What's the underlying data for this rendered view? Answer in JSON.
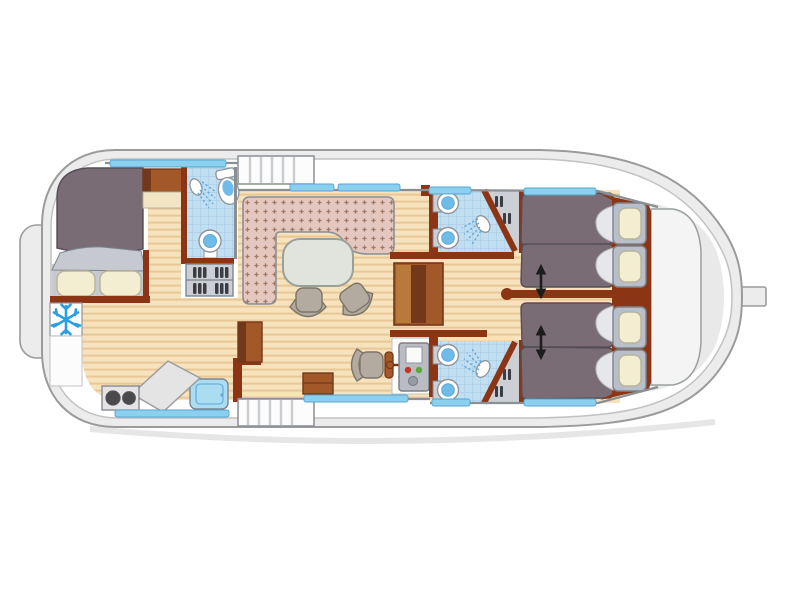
{
  "meta": {
    "title": "Houseboat deck floor plan (top view)",
    "canvas": {
      "width": 800,
      "height": 600
    }
  },
  "palette": {
    "bg": "#ffffff",
    "shadow": "#dedede",
    "hull_fill": "#ececec",
    "hull_stroke": "#9b9b9b",
    "deck_fill": "#ffffff",
    "deck_stroke": "#c2c2c2",
    "bow_fill": "#e9e9e9",
    "bowdeck_fill": "#f4f4f4",
    "bowdeck_stroke": "#9aa0a0",
    "wood_base": "#f6e2bd",
    "wood_stripe": "#e9c897",
    "tile_base": "#c2dff2",
    "tile_line": "#a3c9e4",
    "window_blue": "#8bd0ef",
    "window_stroke": "#58a6cf",
    "wall_gray": "#8a8f94",
    "wall_brown": "#8c3514",
    "furniture_brown": "#a3582a",
    "furniture_brown_light": "#b87a3a",
    "furniture_brown_dark": "#73381a",
    "bench_base": "#e4c7be",
    "bench_motif": "#a17a67",
    "bed_dark": "#796c74",
    "bed_stroke": "#554e57",
    "bed_fold": "#e6e7ea",
    "bed_fold_stroke": "#b5b8bd",
    "sheet_gray": "#c6cad0",
    "frame_gray": "#b9bfc9",
    "frame_stroke": "#7e848e",
    "pillow_cream": "#f3edd1",
    "pillow_stroke": "#b9b39a",
    "closet_gray": "#ccd0d4",
    "closet_item": "#3c3c44",
    "chair_fill": "#b4aba0",
    "chair_stroke": "#7c7469",
    "table_fill": "#e0e4dc",
    "table_stroke": "#99a099",
    "console_fill": "#b9bdc3",
    "console_stroke": "#7c8086",
    "screen_white": "#fafafa",
    "button_red": "#c93326",
    "button_green": "#58a834",
    "knob_gray": "#969da5",
    "fixture_white": "#ffffff",
    "fixture_stroke": "#8f959b",
    "basin_blue": "#6fbce8",
    "spray_blue": "#5fa8d8",
    "snowflake_blue": "#2b9fe0",
    "stairs_fill": "#fcfcfc",
    "stairs_tread": "#c9cdd1",
    "arrow_black": "#1d1d1d",
    "counter_gray": "#e4e4e4",
    "burner_dark": "#4a4a4a",
    "sink_blue": "#aadcf2",
    "cream_top": "#f3e4c4"
  },
  "areas": {
    "aft_cabin": {
      "label": "Aft cabin with double bed and two pillows"
    },
    "aft_bathroom": {
      "label": "Aft bathroom with shower, toilet and washbasin"
    },
    "galley": {
      "label": "Galley with two-burner stove, worktop, sink and refrigerator"
    },
    "salon": {
      "label": "Salon with L-shaped sofa, oval table and two chairs"
    },
    "helm": {
      "label": "Inside steering position with seat, wheel and control console"
    },
    "bathroom_top": {
      "label": "Forward bathroom (top) with two washbasins and shower"
    },
    "bathroom_bottom": {
      "label": "Forward bathroom (bottom) with two washbasins and shower"
    },
    "cabin_top": {
      "label": "Forward cabin (top) with two single beds"
    },
    "cabin_bottom": {
      "label": "Forward cabin (bottom) with two single beds"
    },
    "bow_deck": {
      "label": "Bow deck"
    },
    "stairs_top": {
      "label": "Companionway steps to side deck (top)"
    },
    "stairs_bottom": {
      "label": "Companionway steps to side deck (bottom)"
    },
    "wardrobe": {
      "label": "Wardrobe"
    },
    "shelves": {
      "label": "Shelf unit with bottles"
    },
    "fridge": {
      "label": "Refrigerator / freezer (snowflake)"
    }
  },
  "inventory": {
    "double_beds": 1,
    "single_beds": 4,
    "pillows": 6,
    "windows": 9,
    "washbasins": 5,
    "showers": 3,
    "toilets": 1,
    "stairs": 2,
    "slide_arrows": 2
  },
  "icons": {
    "snowflake": "snowflake-icon",
    "shower": "shower-icon",
    "sink": "sink-icon",
    "toilet": "toilet-icon",
    "steering": "steering-wheel-icon",
    "arrow": "double-arrow-icon"
  }
}
